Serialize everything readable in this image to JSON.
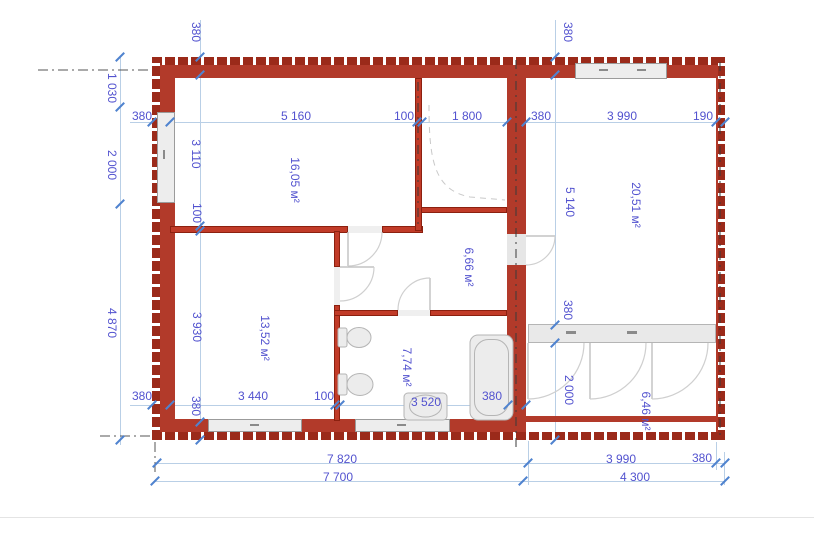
{
  "plan": {
    "name": "floor-plan"
  },
  "dims": {
    "top": [
      "380",
      "5 160",
      "100",
      "1 800",
      "380",
      "3 990",
      "190"
    ],
    "left_outer": [
      "1 030",
      "2 000",
      "4 870"
    ],
    "left_inner": [
      "380",
      "3 110",
      "100",
      "3 930",
      "380"
    ],
    "right_inner": [
      "380",
      "5 140",
      "380",
      "2 000"
    ],
    "bottom_inner": [
      "380",
      "3 440",
      "100",
      "3 520",
      "380"
    ],
    "bottom_right": [
      "3 990",
      "380"
    ],
    "totals": [
      "7 820",
      "7 700",
      "4 300"
    ]
  },
  "rooms": [
    {
      "name": "room-top-left",
      "area": "16,05 м²"
    },
    {
      "name": "room-bottom-left",
      "area": "13,52 м²"
    },
    {
      "name": "hallway",
      "area": "6,66 м²"
    },
    {
      "name": "bathroom",
      "area": "7,74 м²"
    },
    {
      "name": "room-right",
      "area": "20,51 м²"
    },
    {
      "name": "veranda",
      "area": "6,46 м²"
    }
  ],
  "colors": {
    "wall": "#b23a2a",
    "dimension_text": "#5252cf",
    "dimension_line": "#b9cfe6",
    "window": "#ededed"
  }
}
